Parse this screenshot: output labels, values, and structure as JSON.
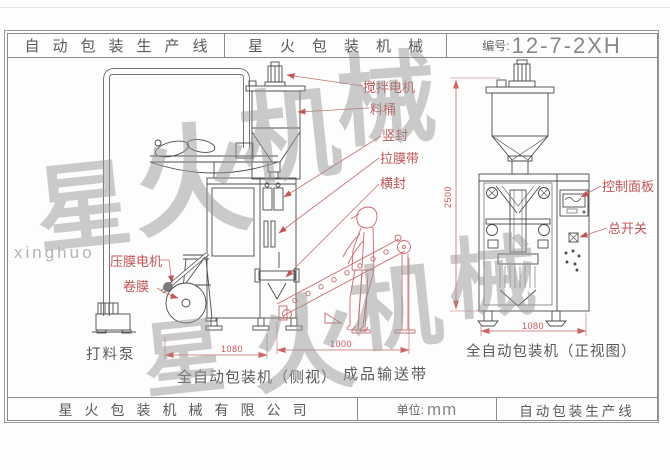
{
  "header": {
    "cell1": "自动包装生产线",
    "cell2": "星火包装机械",
    "no_label": "编号:",
    "no_value": "12-7-2XH"
  },
  "footer": {
    "company": "星火包装机械有限公司",
    "unit_label": "单位:",
    "unit_value": "mm",
    "product_line": "自动包装生产线"
  },
  "labels": {
    "mixer_motor": "搅拌电机",
    "material_barrel": "料桶",
    "vertical_seal": "竖封",
    "film_pull_belt": "拉膜带",
    "horizontal_seal": "横封",
    "film_press_motor": "压膜电机",
    "film_roll": "卷膜",
    "control_panel": "控制面板",
    "main_switch": "总开关"
  },
  "captions": {
    "feed_pump": "打料泵",
    "side_view": "全自动包装机（侧视）",
    "conveyor": "成品输送带",
    "front_view": "全自动包装机（正视图）"
  },
  "dimensions": {
    "side_width": "1080",
    "conveyor_length": "1000",
    "front_width": "1080",
    "machine_height": "2500"
  },
  "watermark": {
    "chars": [
      "星",
      "火",
      "机",
      "械"
    ],
    "latin": "xinghuo"
  },
  "colors": {
    "line": "#4a4a4a",
    "annotation": "#c05555",
    "dimension": "#cc6666",
    "watermark": "#999999"
  }
}
